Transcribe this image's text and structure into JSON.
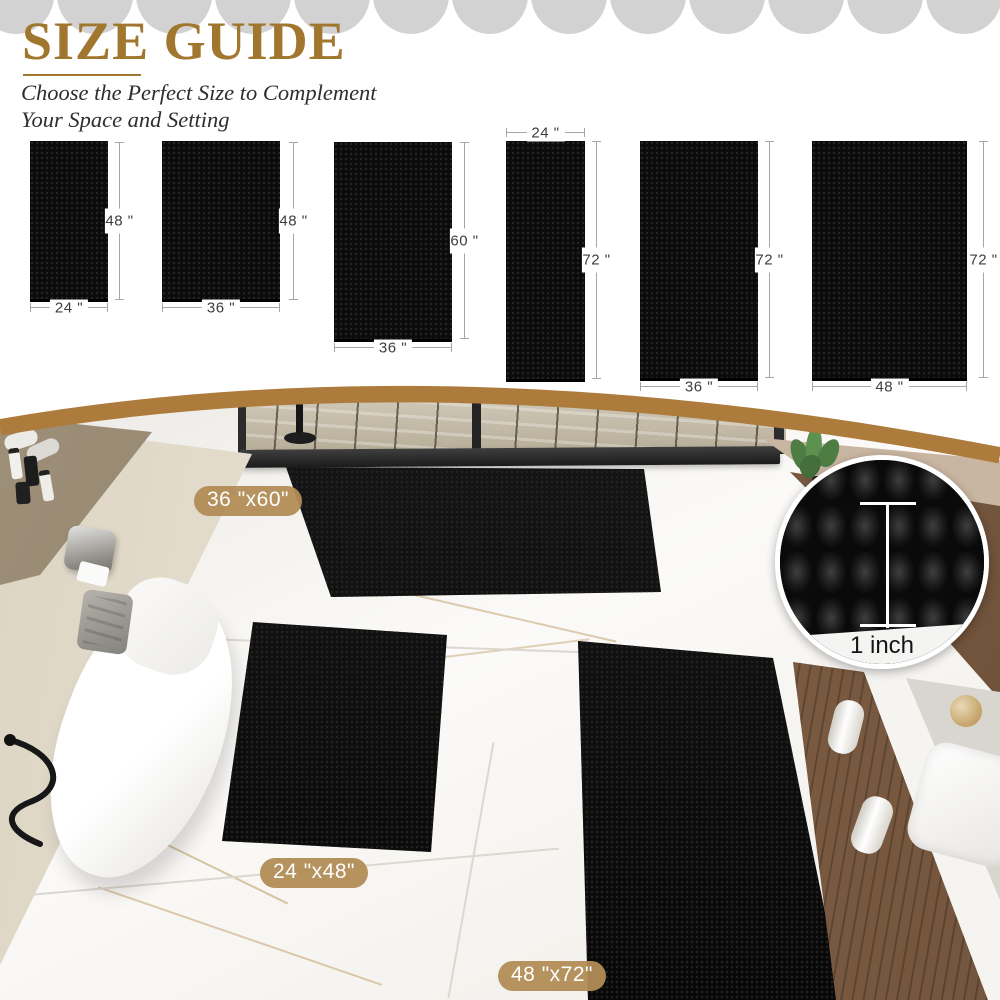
{
  "header": {
    "title": "SIZE GUIDE",
    "subtitle_line1": "Choose the Perfect Size to Complement",
    "subtitle_line2": "Your Space and Setting"
  },
  "size_chart": {
    "items": [
      {
        "width_label": "24 \"",
        "height_label": "48 \""
      },
      {
        "width_label": "36 \"",
        "height_label": "48 \""
      },
      {
        "width_label": "36 \"",
        "height_label": "60 \""
      },
      {
        "width_label": "24 \"",
        "height_label": "72 \""
      },
      {
        "width_label": "36 \"",
        "height_label": "72 \""
      },
      {
        "width_label": "48 \"",
        "height_label": "72 \""
      }
    ]
  },
  "scene": {
    "rug_tags": [
      "36 \"x60\"",
      "24 \"x48\"",
      "48 \"x72\""
    ],
    "inset_label": "1 inch"
  },
  "colors": {
    "accent_gold": "#a1762f",
    "arc_gold": "#ad7b3c",
    "tag_gold": "#b18c55",
    "scallop_gray": "#d2d2d2",
    "rug_black": "#0b0b0b"
  }
}
